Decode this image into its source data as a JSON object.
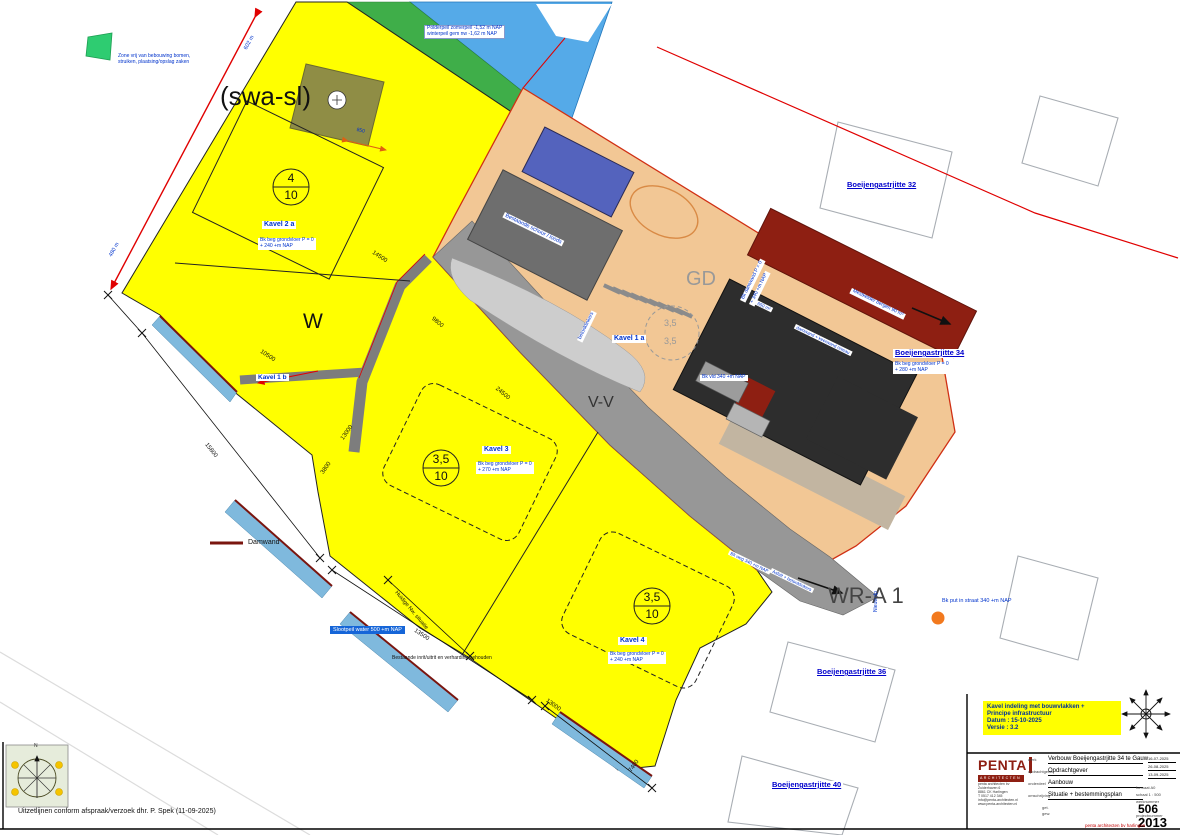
{
  "zoning": {
    "swa_sl": "(swa-sl)",
    "w": "W",
    "vv": "V-V",
    "gd": "GD",
    "wr_a1": "WR-A 1"
  },
  "plots": {
    "k1a": {
      "label": "Kavel 1 a",
      "ratio_a": "3,5",
      "ratio_b": "3,5"
    },
    "k1b": {
      "label": "Kavel 1 b"
    },
    "k2a": {
      "label": "Kavel 2 a",
      "ratio_top": "4",
      "ratio_bottom": "10",
      "note1": "Bk beg grondvloer P = 0",
      "note2": "+ 240 +m NAP"
    },
    "k3": {
      "label": "Kavel 3",
      "ratio_top": "3,5",
      "ratio_bottom": "10",
      "note1": "Bk beg grondvloer P = 0",
      "note2": "+ 270 +m NAP"
    },
    "k4": {
      "label": "Kavel 4",
      "ratio_top": "3,5",
      "ratio_bottom": "10",
      "note1": "Bk beg grondvloer P = 0",
      "note2": "+ 240 +m NAP"
    }
  },
  "streets": {
    "s32": "Boeijengastrjitte 32",
    "s34": "Boeijengastrjitte 34",
    "s36": "Boeijengastrjitte 36",
    "s40": "Boeijengastrjitte 40",
    "s34_note1": "Bk beg grondvloer P = 0",
    "s34_note2": "+ 280 +m NAP"
  },
  "notes": {
    "green1": "Zone vrij van bebouwing bomen,",
    "green2": "struiken, plaatsing/opslag zaken",
    "polder1": "Polderpeil zomerpeil -1,52 m NAP",
    "polder2": "winterpeil gem nw -1,62 m NAP",
    "sloot": "Slootpeil water 500 +m NAP",
    "inrit": "Bestaande inrit/uitrit en verharding behouden",
    "huidig": "Huidige Nw. situatie",
    "put": "Bk put in straat 340 +m NAP",
    "nieuw_dp": "Nieuw dp",
    "uitzet": "Uitzetlijnen conform afspraak/verzoek dhr. P. Spek (11-09-2025)",
    "bk_vld": "Bk vld 340 +m NAP",
    "damwand1": "Bk damwand P = 0",
    "damwand2": "+ 340 +m NAP",
    "mestkelder": "Mestkelder bergen 90 m³",
    "keerwand": "damwand + keerwand niveau",
    "loods": "Bestaande schuur / loods",
    "betonklinkers": "betonklinkers",
    "asfalt": "Asfalt + betonklinkers",
    "bk_weg": "Bk weg 340 +m NAP",
    "area650": "650 m²"
  },
  "legend": {
    "damwand": "Damwand"
  },
  "dims": {
    "d602": "602 m",
    "d480": "480 m",
    "d14500": "14500",
    "d24500": "24500",
    "d9800": "9800",
    "d13000a": "13000",
    "d10500": "10500",
    "d15800": "15800",
    "d13500": "13500",
    "d13000b": "13000",
    "d7400": "7400",
    "d3800": "3800",
    "d850": "850"
  },
  "titleblock": {
    "note1": "Kavel indeling met bouwvlakken +",
    "note2": "Principe infrastructuur",
    "note3": "Datum : 15-10-2025",
    "note4": "Versie : 3.2",
    "logo_main": "PENTA",
    "logo_sub": "ARCHITECTEN",
    "address1": "penta architecten bv",
    "address2": "Zuiderhaven 6",
    "address3": "8861 CK Harlingen",
    "address4": "T 0517 412 345",
    "address5": "info@penta-architecten.nl",
    "address6": "www.penta-architecten.nl",
    "fields": [
      {
        "label": "werk",
        "value": "Verbouw Boeijengastrjitte 34 te Gauw"
      },
      {
        "label": "opdrachtgever",
        "value": "Opdrachtgever"
      },
      {
        "label": "onderdeel",
        "value": "Aanbouw"
      },
      {
        "label": "omschrijving",
        "value": "Situatie + bestemmingsplan"
      }
    ],
    "dates": [
      "16-07-2025",
      "26-08-2025",
      "13-09-2025"
    ],
    "format": "formaat A0",
    "scale": "schaal  1 : 500",
    "wn_label": "werknummer",
    "wn": "506",
    "pn_label": "projectnummer",
    "pn": "2013",
    "get_label": "get.",
    "gew_label": "gew.",
    "footer": "penta architecten bv harlingen"
  },
  "compass": {
    "n": "N"
  }
}
